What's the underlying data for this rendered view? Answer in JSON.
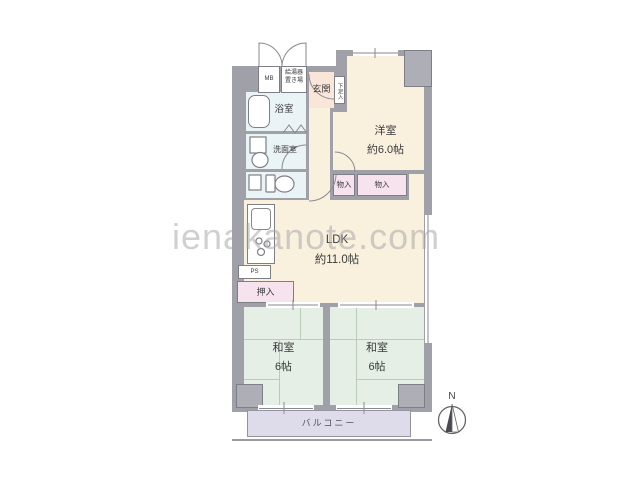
{
  "watermark": "ienakanote.com",
  "compass": {
    "north_label": "N"
  },
  "rooms": {
    "meter_box": "MB",
    "water_heater_line1": "給湯器",
    "water_heater_line2": "置き場",
    "entrance": "玄関",
    "shoe_storage": "下足入",
    "bathroom": "浴室",
    "washroom": "洗面室",
    "western_room_name": "洋室",
    "western_room_size": "約6.0帖",
    "storage_a": "物入",
    "storage_b": "物入",
    "ldk_name": "LDK",
    "ldk_size": "約11.0帖",
    "pipe_space": "PS",
    "futon_closet": "押入",
    "japanese_room_a_name": "和室",
    "japanese_room_a_size": "6帖",
    "japanese_room_b_name": "和室",
    "japanese_room_b_size": "6帖",
    "balcony": "バルコニー"
  },
  "colors": {
    "wall": "#9fa0a8",
    "living_cream": "#faf0de",
    "entrance_peach": "#fae6d8",
    "wet_area_blue": "#eaf3f6",
    "storage_pink": "#f7e3ee",
    "tatami_green": "#e5efe5",
    "balcony_lavender": "#dedceb"
  }
}
